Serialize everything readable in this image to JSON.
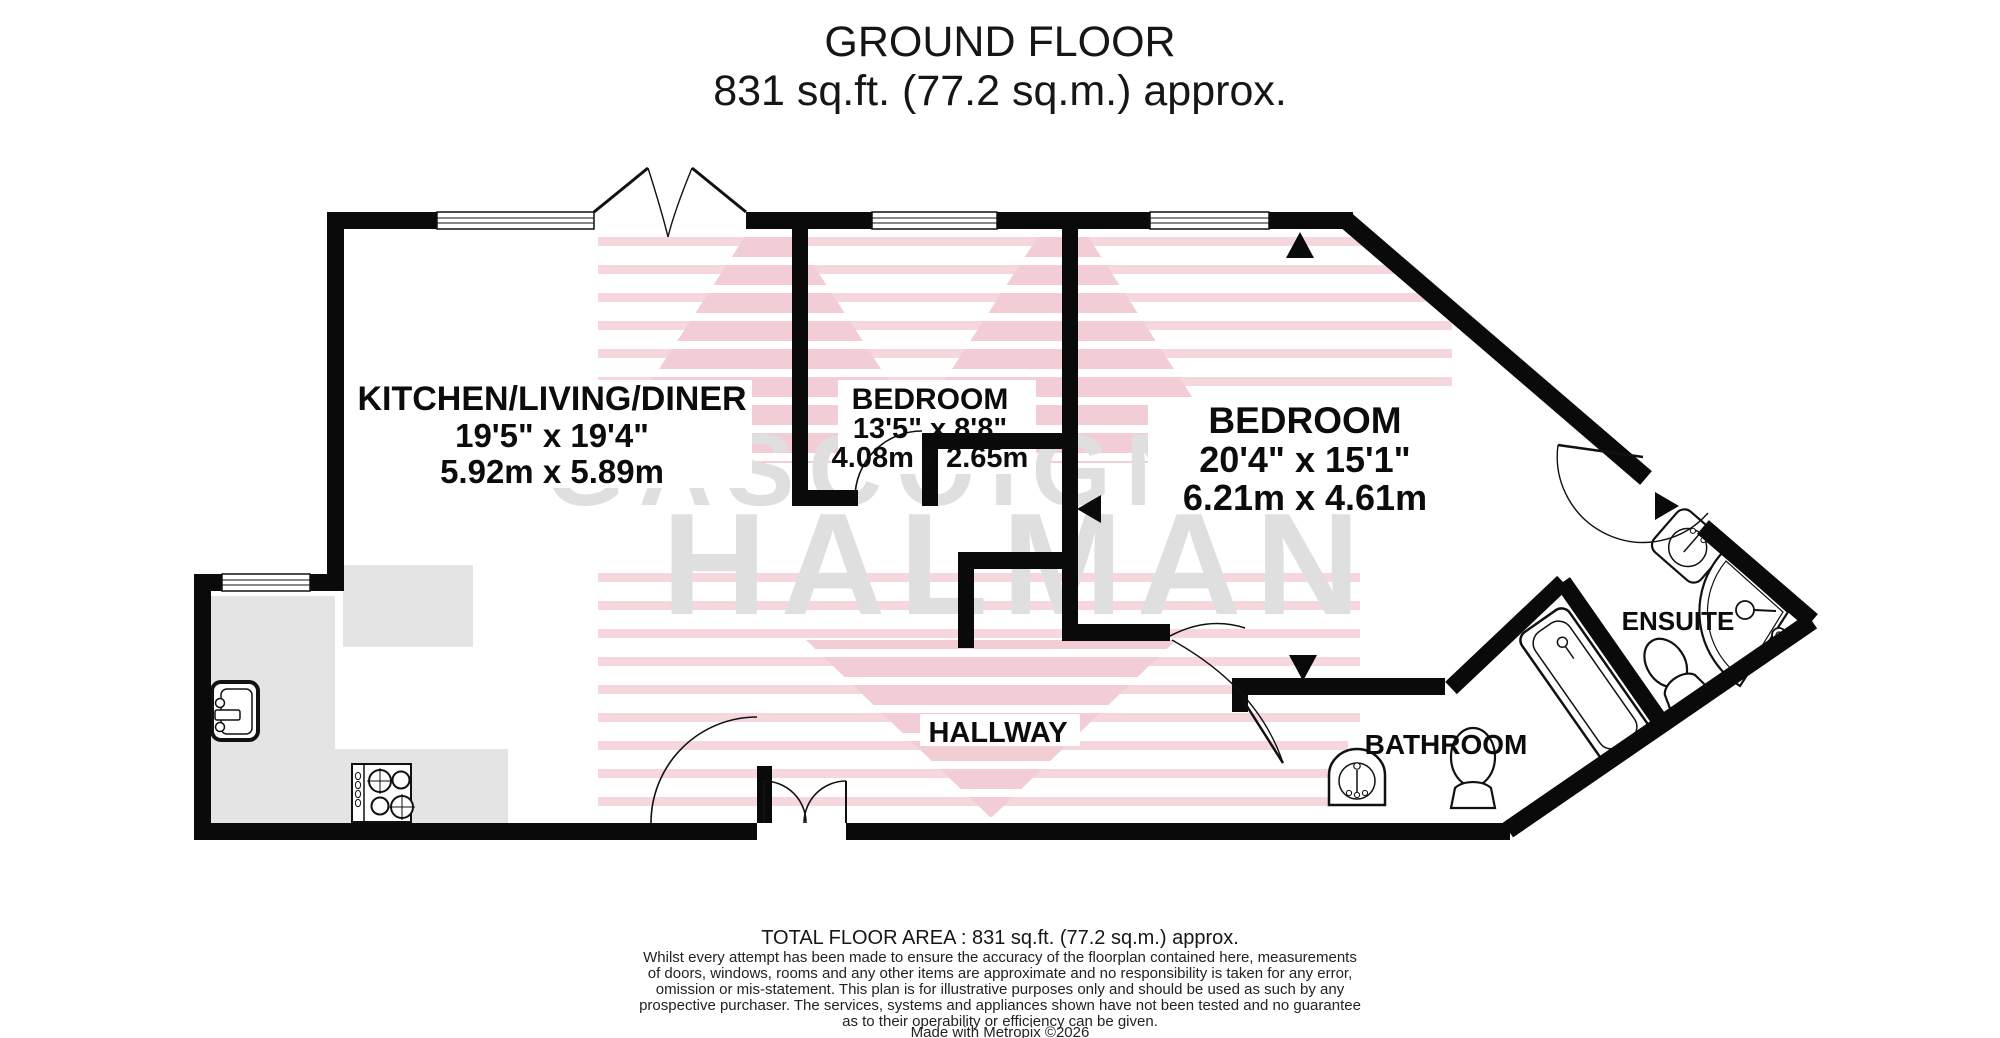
{
  "title": {
    "line1": "GROUND FLOOR",
    "line2": "831 sq.ft. (77.2 sq.m.) approx."
  },
  "watermark": {
    "line1": "GASCOIGNE",
    "line2": "HALMAN",
    "stripe_color": "#f5d7dd",
    "triangle_color": "#f2cdd5",
    "text_color": "#dfdfdf"
  },
  "rooms": [
    {
      "id": "kitchen",
      "name": "KITCHEN/LIVING/DINER",
      "dims_imperial": "19'5\"  x 19'4\"",
      "dims_metric": "5.92m  x 5.89m"
    },
    {
      "id": "bedroom1",
      "name": "BEDROOM",
      "dims_imperial": "13'5\"  x 8'8\"",
      "dims_metric": "4.08m  x 2.65m"
    },
    {
      "id": "bedroom2",
      "name": "BEDROOM",
      "dims_imperial": "20'4\"  x 15'1\"",
      "dims_metric": "6.21m  x 4.61m"
    },
    {
      "id": "hallway",
      "name": "HALLWAY"
    },
    {
      "id": "bathroom",
      "name": "BATHROOM"
    },
    {
      "id": "ensuite",
      "name": "ENSUITE"
    }
  ],
  "footer": {
    "total": "TOTAL FLOOR AREA : 831 sq.ft. (77.2 sq.m.) approx.",
    "disclaimer": [
      "Whilst every attempt has been made to ensure the accuracy of the floorplan contained here, measurements",
      "of doors, windows, rooms and any other items are approximate and no responsibility is taken for any error,",
      "omission or mis-statement. This plan is for illustrative purposes only and should be used as such by any",
      "prospective purchaser. The services, systems and appliances shown have not been tested and no guarantee",
      "as to their operability or efficiency can be given.",
      "Made with Metropix ©2026"
    ]
  }
}
